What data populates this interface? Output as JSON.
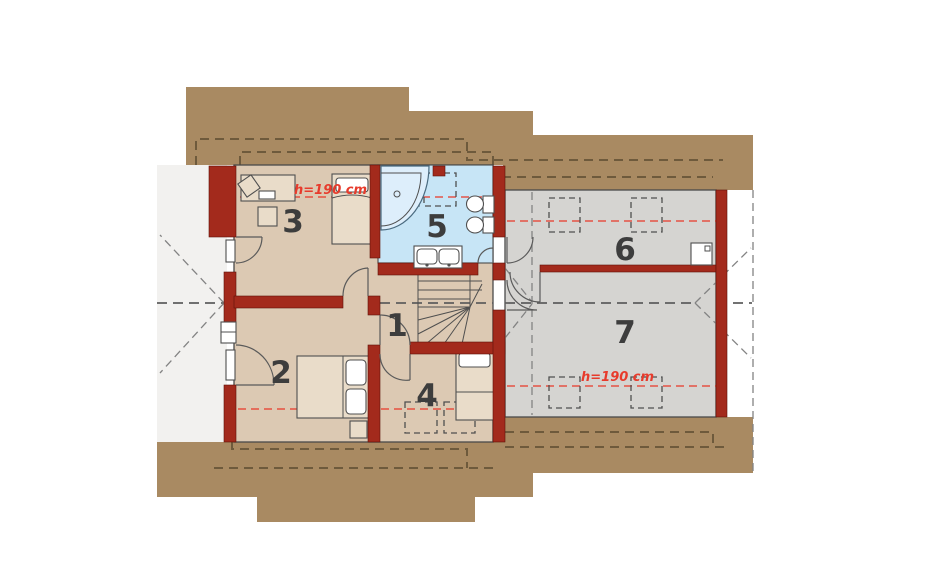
{
  "floorplan": {
    "kind": "attic-storey-house-plan",
    "room_labels": [
      "1",
      "2",
      "3",
      "4",
      "5",
      "6",
      "7"
    ],
    "height_annotations": [
      {
        "text": "h=190 cm"
      },
      {
        "text": "h=190 cm"
      }
    ],
    "colors": {
      "roof_brown": "#a98a62",
      "wall_red": "#a32a1c",
      "floor_beige": "#dcc9b3",
      "floor_bathroom_blue": "#c7e5f6",
      "floor_gray": "#d5d4d1",
      "gable_light": "#f2f1ef",
      "annotation_red": "#e73b2c"
    }
  }
}
